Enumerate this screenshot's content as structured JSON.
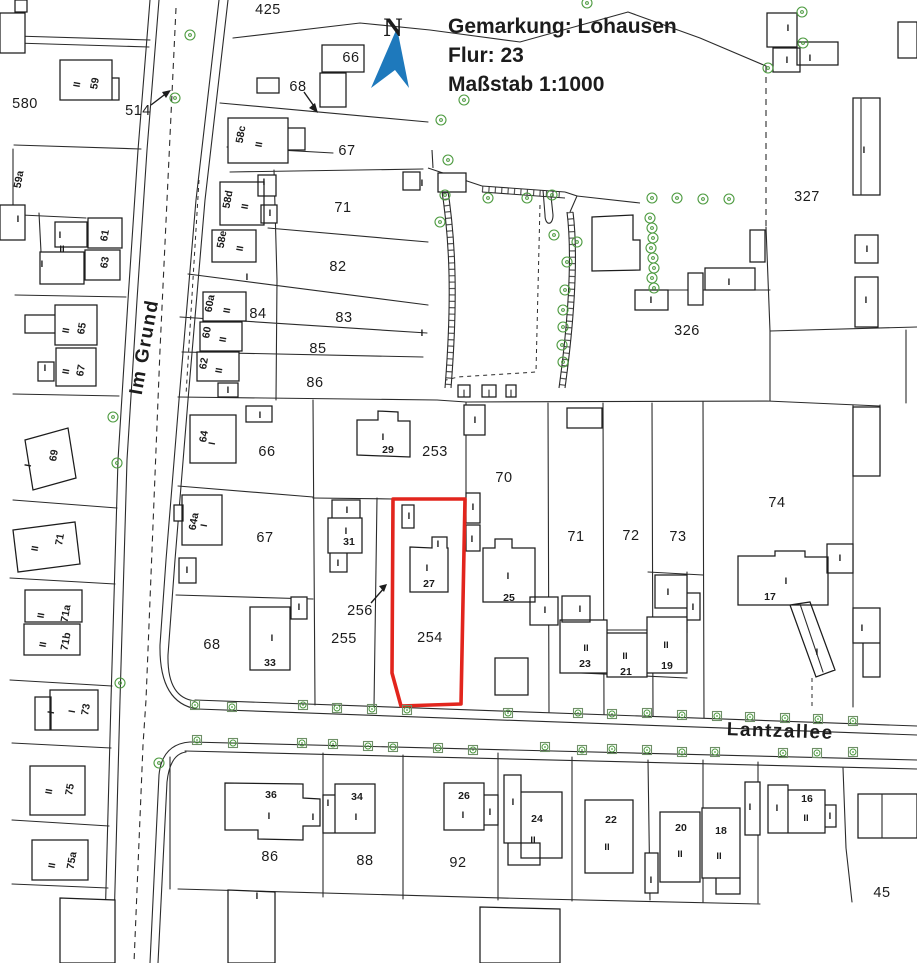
{
  "header": {
    "line1": "Gemarkung: Lohausen",
    "line2": "Flur: 23",
    "line3": "Maßstab 1:1000"
  },
  "north_label": "N",
  "colors": {
    "accent_blue": "#1e79bc",
    "highlight_red": "#e2251d",
    "tree_green": "#4c9a3f",
    "line_black": "#2b2b2b"
  },
  "highlighted_parcel": "254",
  "labels": [
    {
      "t": "Im Grund",
      "x": 150,
      "y": 348,
      "k": "street",
      "r": -80
    },
    {
      "t": "Lantzallee",
      "x": 780,
      "y": 737,
      "k": "street",
      "r": 2
    },
    {
      "t": "425",
      "x": 268,
      "y": 14,
      "k": "parcel"
    },
    {
      "t": "580",
      "x": 25,
      "y": 108,
      "k": "parcel"
    },
    {
      "t": "514",
      "x": 138,
      "y": 115,
      "k": "parcel"
    },
    {
      "t": "66",
      "x": 351,
      "y": 62,
      "k": "parcel"
    },
    {
      "t": "68",
      "x": 298,
      "y": 91,
      "k": "parcel"
    },
    {
      "t": "67",
      "x": 347,
      "y": 155,
      "k": "parcel"
    },
    {
      "t": "71",
      "x": 343,
      "y": 212,
      "k": "parcel"
    },
    {
      "t": "82",
      "x": 338,
      "y": 271,
      "k": "parcel"
    },
    {
      "t": "84",
      "x": 258,
      "y": 318,
      "k": "parcel"
    },
    {
      "t": "83",
      "x": 344,
      "y": 322,
      "k": "parcel"
    },
    {
      "t": "85",
      "x": 318,
      "y": 353,
      "k": "parcel"
    },
    {
      "t": "86",
      "x": 315,
      "y": 387,
      "k": "parcel"
    },
    {
      "t": "327",
      "x": 807,
      "y": 201,
      "k": "parcel"
    },
    {
      "t": "326",
      "x": 687,
      "y": 335,
      "k": "parcel"
    },
    {
      "t": "66",
      "x": 267,
      "y": 456,
      "k": "parcel"
    },
    {
      "t": "253",
      "x": 435,
      "y": 456,
      "k": "parcel"
    },
    {
      "t": "70",
      "x": 504,
      "y": 482,
      "k": "parcel"
    },
    {
      "t": "67",
      "x": 265,
      "y": 542,
      "k": "parcel"
    },
    {
      "t": "71",
      "x": 576,
      "y": 541,
      "k": "parcel"
    },
    {
      "t": "72",
      "x": 631,
      "y": 540,
      "k": "parcel"
    },
    {
      "t": "73",
      "x": 678,
      "y": 541,
      "k": "parcel"
    },
    {
      "t": "74",
      "x": 777,
      "y": 507,
      "k": "parcel"
    },
    {
      "t": "256",
      "x": 360,
      "y": 615,
      "k": "parcel"
    },
    {
      "t": "255",
      "x": 344,
      "y": 643,
      "k": "parcel"
    },
    {
      "t": "254",
      "x": 430,
      "y": 642,
      "k": "parcel",
      "s": 16
    },
    {
      "t": "68",
      "x": 212,
      "y": 649,
      "k": "parcel"
    },
    {
      "t": "86",
      "x": 270,
      "y": 861,
      "k": "parcel"
    },
    {
      "t": "88",
      "x": 365,
      "y": 865,
      "k": "parcel"
    },
    {
      "t": "92",
      "x": 458,
      "y": 867,
      "k": "parcel"
    },
    {
      "t": "45",
      "x": 882,
      "y": 897,
      "k": "parcel"
    },
    {
      "t": "59",
      "x": 98,
      "y": 84,
      "k": "house",
      "r": -80
    },
    {
      "t": "59a",
      "x": 22,
      "y": 180,
      "k": "house",
      "r": -80
    },
    {
      "t": "61",
      "x": 108,
      "y": 236,
      "k": "house",
      "r": -80
    },
    {
      "t": "63",
      "x": 108,
      "y": 263,
      "k": "house",
      "r": -80
    },
    {
      "t": "65",
      "x": 85,
      "y": 329,
      "k": "house",
      "r": -80
    },
    {
      "t": "67",
      "x": 84,
      "y": 371,
      "k": "house",
      "r": -80
    },
    {
      "t": "69",
      "x": 57,
      "y": 456,
      "k": "house",
      "r": -80
    },
    {
      "t": "71",
      "x": 63,
      "y": 540,
      "k": "house",
      "r": -80
    },
    {
      "t": "71a",
      "x": 69,
      "y": 614,
      "k": "house",
      "r": -80
    },
    {
      "t": "71b",
      "x": 69,
      "y": 642,
      "k": "house",
      "r": -80
    },
    {
      "t": "73",
      "x": 89,
      "y": 710,
      "k": "house",
      "r": -80
    },
    {
      "t": "75",
      "x": 73,
      "y": 790,
      "k": "house",
      "r": -80
    },
    {
      "t": "75a",
      "x": 75,
      "y": 861,
      "k": "house",
      "r": -80
    },
    {
      "t": "58c",
      "x": 244,
      "y": 135,
      "k": "house",
      "r": -80
    },
    {
      "t": "58d",
      "x": 231,
      "y": 200,
      "k": "house",
      "r": -80
    },
    {
      "t": "58e",
      "x": 225,
      "y": 240,
      "k": "house",
      "r": -80
    },
    {
      "t": "60a",
      "x": 213,
      "y": 304,
      "k": "house",
      "r": -80
    },
    {
      "t": "60",
      "x": 210,
      "y": 333,
      "k": "house",
      "r": -80
    },
    {
      "t": "62",
      "x": 207,
      "y": 364,
      "k": "house",
      "r": -80
    },
    {
      "t": "64",
      "x": 207,
      "y": 437,
      "k": "house",
      "r": -80
    },
    {
      "t": "64a",
      "x": 197,
      "y": 522,
      "k": "house",
      "r": -80
    },
    {
      "t": "29",
      "x": 388,
      "y": 453,
      "k": "house"
    },
    {
      "t": "31",
      "x": 349,
      "y": 545,
      "k": "house"
    },
    {
      "t": "27",
      "x": 429,
      "y": 587,
      "k": "house"
    },
    {
      "t": "25",
      "x": 509,
      "y": 601,
      "k": "house"
    },
    {
      "t": "33",
      "x": 270,
      "y": 666,
      "k": "house"
    },
    {
      "t": "23",
      "x": 585,
      "y": 667,
      "k": "house"
    },
    {
      "t": "21",
      "x": 626,
      "y": 675,
      "k": "house"
    },
    {
      "t": "19",
      "x": 667,
      "y": 669,
      "k": "house"
    },
    {
      "t": "17",
      "x": 770,
      "y": 600,
      "k": "house"
    },
    {
      "t": "36",
      "x": 271,
      "y": 798,
      "k": "house"
    },
    {
      "t": "34",
      "x": 357,
      "y": 800,
      "k": "house"
    },
    {
      "t": "26",
      "x": 464,
      "y": 799,
      "k": "house"
    },
    {
      "t": "24",
      "x": 537,
      "y": 822,
      "k": "house"
    },
    {
      "t": "22",
      "x": 611,
      "y": 823,
      "k": "house"
    },
    {
      "t": "20",
      "x": 681,
      "y": 831,
      "k": "house"
    },
    {
      "t": "18",
      "x": 721,
      "y": 834,
      "k": "house"
    },
    {
      "t": "16",
      "x": 807,
      "y": 802,
      "k": "house"
    },
    {
      "t": "II",
      "x": 80,
      "y": 85,
      "k": "storey",
      "r": -80
    },
    {
      "t": "II",
      "x": 262,
      "y": 145,
      "k": "storey",
      "r": -80
    },
    {
      "t": "II",
      "x": 248,
      "y": 207,
      "k": "storey",
      "r": -80
    },
    {
      "t": "II",
      "x": 243,
      "y": 249,
      "k": "storey",
      "r": -80
    },
    {
      "t": "II",
      "x": 230,
      "y": 311,
      "k": "storey",
      "r": -80
    },
    {
      "t": "II",
      "x": 226,
      "y": 340,
      "k": "storey",
      "r": -80
    },
    {
      "t": "II",
      "x": 222,
      "y": 371,
      "k": "storey",
      "r": -80
    },
    {
      "t": "I",
      "x": 215,
      "y": 444,
      "k": "storey",
      "r": -80
    },
    {
      "t": "I",
      "x": 207,
      "y": 526,
      "k": "storey",
      "r": -80
    },
    {
      "t": "II",
      "x": 69,
      "y": 331,
      "k": "storey",
      "r": -80
    },
    {
      "t": "II",
      "x": 69,
      "y": 372,
      "k": "storey",
      "r": -80
    },
    {
      "t": "II",
      "x": 38,
      "y": 549,
      "k": "storey",
      "r": -80
    },
    {
      "t": "II",
      "x": 44,
      "y": 616,
      "k": "storey",
      "r": -80
    },
    {
      "t": "II",
      "x": 46,
      "y": 645,
      "k": "storey",
      "r": -80
    },
    {
      "t": "II",
      "x": 52,
      "y": 792,
      "k": "storey",
      "r": -80
    },
    {
      "t": "II",
      "x": 55,
      "y": 866,
      "k": "storey",
      "r": -80
    },
    {
      "t": "I",
      "x": 31,
      "y": 466,
      "k": "storey",
      "r": -80
    },
    {
      "t": "I",
      "x": 75,
      "y": 712,
      "k": "storey",
      "r": -80
    },
    {
      "t": "I",
      "x": 54,
      "y": 713,
      "k": "storey",
      "r": -80
    },
    {
      "t": "I",
      "x": 18,
      "y": 222,
      "k": "storey"
    },
    {
      "t": "I",
      "x": 60,
      "y": 238,
      "k": "storey"
    },
    {
      "t": "II",
      "x": 62,
      "y": 252,
      "k": "storey"
    },
    {
      "t": "I",
      "x": 42,
      "y": 267,
      "k": "storey"
    },
    {
      "t": "I",
      "x": 45,
      "y": 371,
      "k": "storey"
    },
    {
      "t": "I",
      "x": 264,
      "y": 185,
      "k": "storey"
    },
    {
      "t": "I",
      "x": 270,
      "y": 216,
      "k": "storey"
    },
    {
      "t": "I",
      "x": 247,
      "y": 280,
      "k": "storey"
    },
    {
      "t": "I",
      "x": 422,
      "y": 186,
      "k": "storey"
    },
    {
      "t": "I",
      "x": 422,
      "y": 336,
      "k": "storey"
    },
    {
      "t": "I",
      "x": 228,
      "y": 393,
      "k": "storey"
    },
    {
      "t": "I",
      "x": 260,
      "y": 418,
      "k": "storey"
    },
    {
      "t": "I",
      "x": 187,
      "y": 573,
      "k": "storey"
    },
    {
      "t": "I",
      "x": 383,
      "y": 440,
      "k": "storey"
    },
    {
      "t": "I",
      "x": 347,
      "y": 513,
      "k": "storey"
    },
    {
      "t": "I",
      "x": 346,
      "y": 534,
      "k": "storey"
    },
    {
      "t": "I",
      "x": 338,
      "y": 566,
      "k": "storey"
    },
    {
      "t": "I",
      "x": 409,
      "y": 519,
      "k": "storey"
    },
    {
      "t": "I",
      "x": 438,
      "y": 547,
      "k": "storey"
    },
    {
      "t": "I",
      "x": 427,
      "y": 571,
      "k": "storey"
    },
    {
      "t": "I",
      "x": 473,
      "y": 510,
      "k": "storey"
    },
    {
      "t": "I",
      "x": 472,
      "y": 542,
      "k": "storey"
    },
    {
      "t": "I",
      "x": 508,
      "y": 579,
      "k": "storey"
    },
    {
      "t": "I",
      "x": 545,
      "y": 613,
      "k": "storey"
    },
    {
      "t": "I",
      "x": 272,
      "y": 641,
      "k": "storey"
    },
    {
      "t": "I",
      "x": 299,
      "y": 610,
      "k": "storey"
    },
    {
      "t": "I",
      "x": 475,
      "y": 423,
      "k": "storey"
    },
    {
      "t": "I",
      "x": 580,
      "y": 612,
      "k": "storey"
    },
    {
      "t": "II",
      "x": 586,
      "y": 651,
      "k": "storey"
    },
    {
      "t": "II",
      "x": 625,
      "y": 659,
      "k": "storey"
    },
    {
      "t": "II",
      "x": 666,
      "y": 648,
      "k": "storey"
    },
    {
      "t": "I",
      "x": 668,
      "y": 595,
      "k": "storey"
    },
    {
      "t": "I",
      "x": 693,
      "y": 610,
      "k": "storey"
    },
    {
      "t": "I",
      "x": 786,
      "y": 584,
      "k": "storey"
    },
    {
      "t": "I",
      "x": 840,
      "y": 561,
      "k": "storey"
    },
    {
      "t": "I",
      "x": 817,
      "y": 655,
      "k": "storey"
    },
    {
      "t": "I",
      "x": 862,
      "y": 631,
      "k": "storey"
    },
    {
      "t": "I",
      "x": 864,
      "y": 153,
      "k": "storey"
    },
    {
      "t": "I",
      "x": 867,
      "y": 252,
      "k": "storey"
    },
    {
      "t": "I",
      "x": 866,
      "y": 303,
      "k": "storey"
    },
    {
      "t": "I",
      "x": 788,
      "y": 31,
      "k": "storey"
    },
    {
      "t": "I",
      "x": 787,
      "y": 63,
      "k": "storey"
    },
    {
      "t": "I",
      "x": 810,
      "y": 61,
      "k": "storey"
    },
    {
      "t": "I",
      "x": 729,
      "y": 285,
      "k": "storey"
    },
    {
      "t": "I",
      "x": 651,
      "y": 303,
      "k": "storey"
    },
    {
      "t": "I",
      "x": 269,
      "y": 819,
      "k": "storey"
    },
    {
      "t": "I",
      "x": 313,
      "y": 820,
      "k": "storey"
    },
    {
      "t": "I",
      "x": 328,
      "y": 806,
      "k": "storey"
    },
    {
      "t": "I",
      "x": 356,
      "y": 820,
      "k": "storey"
    },
    {
      "t": "I",
      "x": 463,
      "y": 818,
      "k": "storey"
    },
    {
      "t": "I",
      "x": 490,
      "y": 815,
      "k": "storey"
    },
    {
      "t": "I",
      "x": 513,
      "y": 805,
      "k": "storey"
    },
    {
      "t": "II",
      "x": 533,
      "y": 843,
      "k": "storey"
    },
    {
      "t": "II",
      "x": 607,
      "y": 850,
      "k": "storey"
    },
    {
      "t": "II",
      "x": 680,
      "y": 857,
      "k": "storey"
    },
    {
      "t": "II",
      "x": 719,
      "y": 859,
      "k": "storey"
    },
    {
      "t": "II",
      "x": 806,
      "y": 821,
      "k": "storey"
    },
    {
      "t": "I",
      "x": 777,
      "y": 811,
      "k": "storey"
    },
    {
      "t": "I",
      "x": 830,
      "y": 819,
      "k": "storey"
    },
    {
      "t": "I",
      "x": 750,
      "y": 810,
      "k": "storey"
    },
    {
      "t": "I",
      "x": 651,
      "y": 883,
      "k": "storey"
    },
    {
      "t": "I",
      "x": 257,
      "y": 899,
      "k": "storey"
    }
  ],
  "trees": {
    "round": [
      [
        190,
        35
      ],
      [
        175,
        98
      ],
      [
        441,
        120
      ],
      [
        464,
        100
      ],
      [
        587,
        3
      ],
      [
        113,
        417
      ],
      [
        117,
        463
      ],
      [
        120,
        683
      ],
      [
        159,
        763
      ],
      [
        448,
        160
      ],
      [
        445,
        195
      ],
      [
        440,
        222
      ],
      [
        488,
        198
      ],
      [
        527,
        198
      ],
      [
        552,
        195
      ],
      [
        554,
        235
      ],
      [
        577,
        242
      ],
      [
        567,
        262
      ],
      [
        565,
        290
      ],
      [
        563,
        310
      ],
      [
        563,
        327
      ],
      [
        562,
        345
      ],
      [
        563,
        362
      ],
      [
        652,
        198
      ],
      [
        677,
        198
      ],
      [
        703,
        199
      ],
      [
        729,
        199
      ],
      [
        650,
        218
      ],
      [
        652,
        228
      ],
      [
        653,
        238
      ],
      [
        651,
        248
      ],
      [
        653,
        258
      ],
      [
        654,
        268
      ],
      [
        652,
        278
      ],
      [
        654,
        288
      ],
      [
        802,
        12
      ],
      [
        803,
        43
      ],
      [
        768,
        68
      ]
    ],
    "square": [
      [
        195,
        705
      ],
      [
        232,
        707
      ],
      [
        303,
        705
      ],
      [
        337,
        708
      ],
      [
        372,
        709
      ],
      [
        407,
        710
      ],
      [
        508,
        713
      ],
      [
        578,
        713
      ],
      [
        612,
        714
      ],
      [
        647,
        713
      ],
      [
        682,
        715
      ],
      [
        717,
        716
      ],
      [
        750,
        717
      ],
      [
        785,
        718
      ],
      [
        818,
        719
      ],
      [
        853,
        721
      ],
      [
        197,
        740
      ],
      [
        233,
        743
      ],
      [
        302,
        743
      ],
      [
        333,
        744
      ],
      [
        368,
        746
      ],
      [
        393,
        747
      ],
      [
        438,
        748
      ],
      [
        473,
        750
      ],
      [
        545,
        747
      ],
      [
        582,
        750
      ],
      [
        612,
        749
      ],
      [
        647,
        750
      ],
      [
        682,
        752
      ],
      [
        715,
        752
      ],
      [
        783,
        753
      ],
      [
        817,
        753
      ],
      [
        853,
        752
      ]
    ]
  }
}
